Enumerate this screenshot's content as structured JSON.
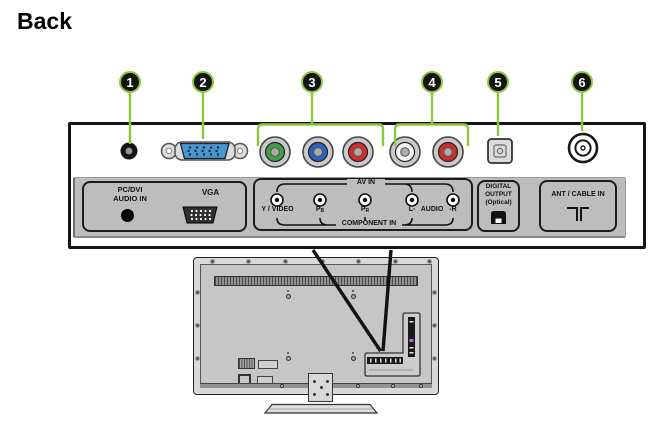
{
  "title": "Back",
  "colors": {
    "accent_green": "#8dc63f",
    "jack_green": "#3f9e47",
    "jack_blue": "#2c62b8",
    "jack_red": "#d02e2e",
    "jack_white": "#f5f5f5",
    "vga_blue": "#4596d2",
    "port_highlight_purple": "#b36bc8"
  },
  "callouts": [
    "1",
    "2",
    "3",
    "4",
    "5",
    "6"
  ],
  "panel": {
    "pc_dvi_box": {
      "line1": "PC/DVI",
      "line2": "AUDIO IN",
      "vga": "VGA"
    },
    "av_box": {
      "av_in": "AV IN",
      "component_in": "COMPONENT IN",
      "y_video": "Y / VIDEO",
      "pb": {
        "main": "P",
        "sub": "B"
      },
      "pr": {
        "main": "P",
        "sub": "R"
      },
      "audio_l": "L-",
      "audio": "AUDIO",
      "audio_r": "-R"
    },
    "digital_box": {
      "line1": "DIGITAL",
      "line2": "OUTPUT",
      "line3": "(Optical)"
    },
    "ant_box": {
      "label": "ANT / CABLE IN"
    }
  }
}
